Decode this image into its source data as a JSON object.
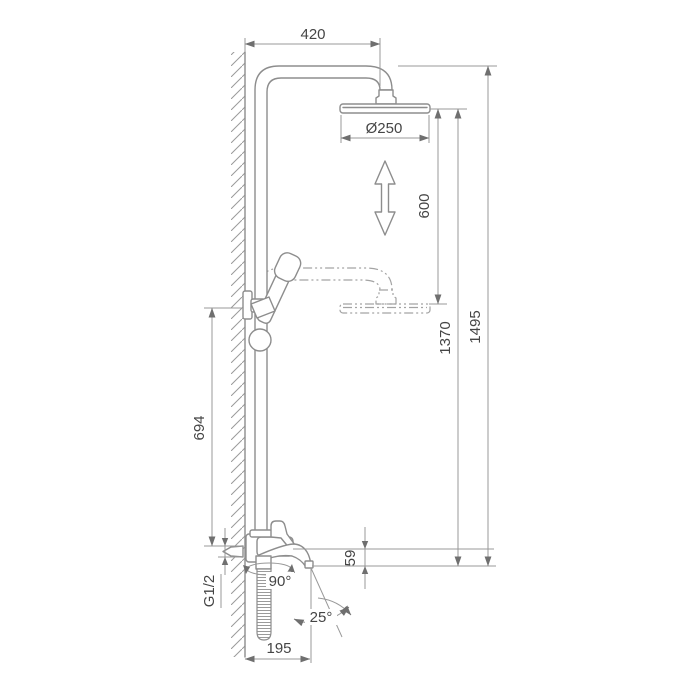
{
  "drawing": {
    "kind": "shower-system-dimension-drawing",
    "dims": {
      "top_offset": "420",
      "head_diameter": "Ø250",
      "adjust_range": "600",
      "head_height": "1370",
      "total_height": "1495",
      "bracket_height": "694",
      "spout_drop": "59",
      "inlet_thread": "G1/2",
      "hose_swivel": "90°",
      "spout_swivel": "25°",
      "spout_reach": "195"
    },
    "colors": {
      "background": "#ffffff",
      "line": "#8d8d8d",
      "dimension_line": "#999999",
      "text": "#454545"
    }
  }
}
